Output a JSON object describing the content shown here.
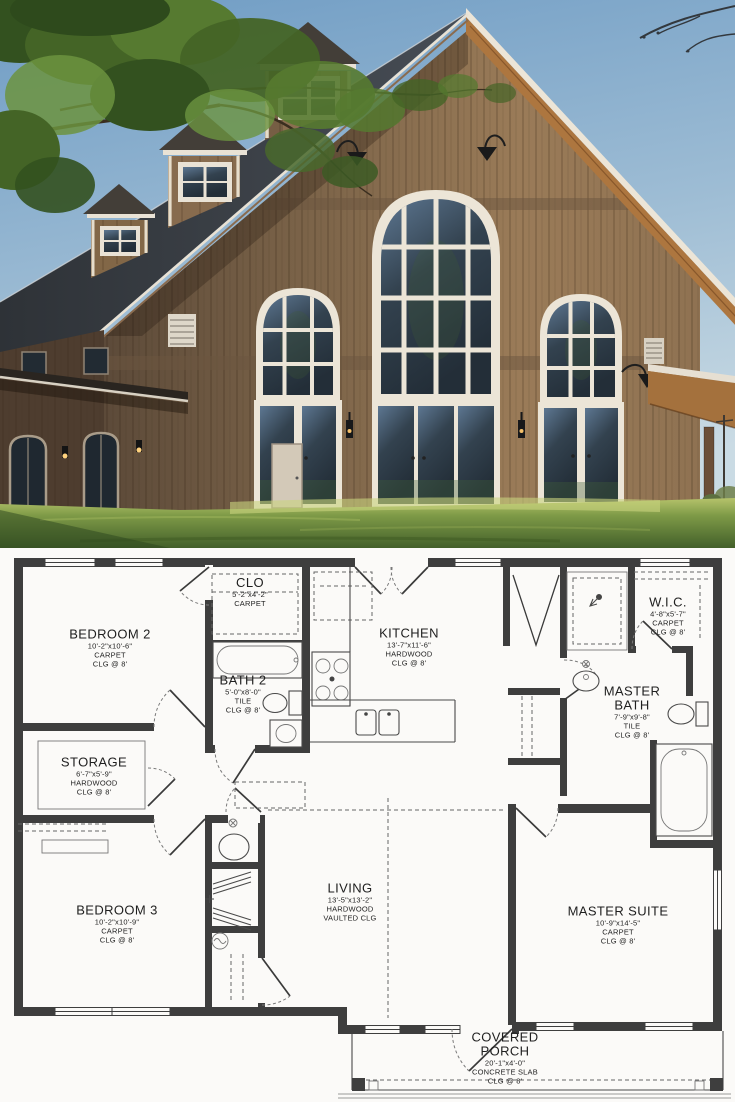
{
  "photo": {
    "palette": {
      "sky_top": "#6f9cc4",
      "sky_bottom": "#cadbe4",
      "roof_dark": "#34383e",
      "cupola_roof": "#433e38",
      "wood_light": "#9a7b58",
      "wood_dark": "#5c4a39",
      "trim_white": "#ece5d7",
      "soffit_wood": "#ad763f",
      "glass_dark": "#2d3a47",
      "grass_light": "#b6c36b",
      "grass_dark": "#43602a",
      "foliage_green": "#4c6b2c",
      "wing_shadow": "#4e3d2f"
    }
  },
  "floor_plan": {
    "palette": {
      "wall": "#3e3e3e",
      "line": "#4a4a4a",
      "dash": "#666666",
      "text": "#1f1f1f",
      "background": "#fbfaf8"
    },
    "rooms": [
      {
        "name": "BEDROOM 2",
        "dims": "10'-2\"x10'-6\"",
        "floor": "CARPET",
        "ceiling": "CLG @ 8'"
      },
      {
        "name": "CLO",
        "dims": "5'-2\"x4'-2\"",
        "floor": "CARPET"
      },
      {
        "name": "BATH 2",
        "dims": "5'-0\"x8'-0\"",
        "floor": "TILE",
        "ceiling": "CLG @ 8'"
      },
      {
        "name": "KITCHEN",
        "dims": "13'-7\"x11'-6\"",
        "floor": "HARDWOOD",
        "ceiling": "CLG @ 8'"
      },
      {
        "name": "W.I.C.",
        "dims": "4'-8\"x5'-7\"",
        "floor": "CARPET",
        "ceiling": "CLG @ 8'"
      },
      {
        "name": "MASTER BATH",
        "dims": "7'-9\"x9'-8\"",
        "floor": "TILE",
        "ceiling": "CLG @ 8'"
      },
      {
        "name": "STORAGE",
        "dims": "6'-7\"x5'-9\"",
        "floor": "HARDWOOD",
        "ceiling": "CLG @ 8'"
      },
      {
        "name": "BEDROOM 3",
        "dims": "10'-2\"x10'-9\"",
        "floor": "CARPET",
        "ceiling": "CLG @ 8'"
      },
      {
        "name": "LIVING",
        "dims": "13'-5\"x13'-2\"",
        "floor": "HARDWOOD",
        "ceiling": "VAULTED CLG"
      },
      {
        "name": "MASTER SUITE",
        "dims": "10'-9\"x14'-5\"",
        "floor": "CARPET",
        "ceiling": "CLG @ 8'"
      },
      {
        "name": "COVERED PORCH",
        "dims": "20'-1\"x4'-0\"",
        "floor": "CONCRETE SLAB",
        "ceiling": "CLG @ 8'"
      }
    ]
  }
}
